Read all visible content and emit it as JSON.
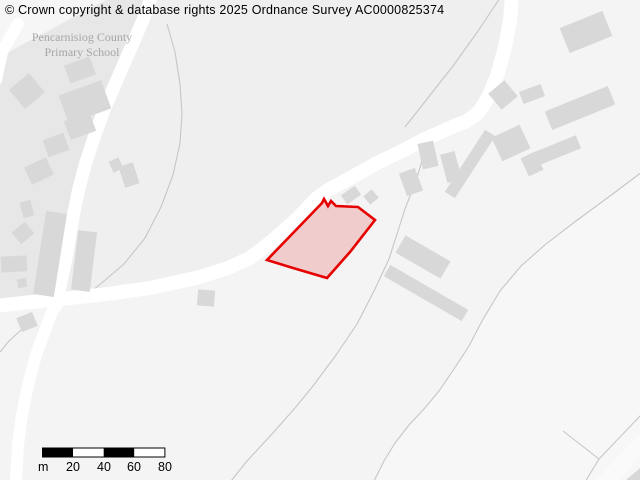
{
  "attribution": "© Crown copyright & database rights 2025 Ordnance Survey AC0000825374",
  "labels": {
    "school_line1": "Pencarnisiog County",
    "school_line2": "Primary School"
  },
  "scale_bar": {
    "unit": "m",
    "ticks": [
      "20",
      "40",
      "60",
      "80"
    ],
    "segment_meters": 20,
    "x": 42.5,
    "y": 448,
    "width": 122.4,
    "height": 9
  },
  "colors": {
    "background": "#efefef",
    "parcel_school": "#e7e7e7",
    "parcel_light": "#f4f4f4",
    "parcel_lighter": "#f7f7f7",
    "building": "#d8d8d8",
    "road": "#ffffff",
    "boundary": "#c6c6c6",
    "highlight_stroke": "#e60000",
    "highlight_fill": "rgba(230,0,0,0.16)",
    "text": "#000000",
    "label": "#a6a6a6"
  },
  "map": {
    "parcels": [
      {
        "name": "parcel-south-of-main-road",
        "points": "-6,312 50,307 100,302 150,295 196,285 228,275 250,265 272,248 297,226 317,205 328,197 352,184 377,170 402,158 427,145 452,134 467,128 479,119 489,103 498,80 505,54 510,28 512,-6 646,-6 646,486 -6,486",
        "fill": "#f4f4f4"
      },
      {
        "name": "parcel-east-of-long-boundary",
        "points": "642,172 610,196 576,221 546,244 521,266 500,291 482,321 469,346 454,369 439,391 424,409 409,425 395,443 384,461 374,481 646,481 646,172",
        "fill": "#f7f7f7"
      },
      {
        "name": "parcel-school-grounds",
        "points": "0,57 107,0 146,0 126,48 109,88 97,125 88,158 80,190 73,222 68,252 62,282 55,306 0,306",
        "fill": "#e7e7e7"
      },
      {
        "name": "parcel-northwest-corner",
        "points": "0,0 105,0 0,56",
        "fill": "#f6f6f6"
      },
      {
        "name": "track-bottom-right-corner",
        "path": "M 600 488 L 652 432",
        "width": 16,
        "stroke": "#fafafa"
      }
    ],
    "boundaries": [
      {
        "name": "boundary-school-field-curve",
        "path": "M 167 24 L 175 52 L 180 84 L 182 114 L 180 143 L 173 175 L 161 207 L 145 238 L 124 264 L 104 281 L 92 291"
      },
      {
        "name": "boundary-west-of-upper-road",
        "path": "M 500 -2 L 478 31 L 453 66 L 427 99 L 405 127"
      },
      {
        "name": "boundary-south-of-bend",
        "path": "M 420 142 L 424 154 L 417 178 L 405 209 L 397 234 L 389 259 L 374 291 L 357 324 L 336 355 L 313 386 L 295 408 L 272 434 L 247 461 L 231 481"
      },
      {
        "name": "boundary-long-east-curve",
        "path": "M 642 172 L 610 196 L 576 221 L 546 244 L 521 266 L 500 291 L 482 321 L 469 346 L 454 369 L 439 391 L 424 409 L 409 425 L 395 443 L 384 461 L 374 481"
      },
      {
        "name": "boundary-junction-southwest",
        "path": "M 33 321 L 20 331 L 9 341 L 0 352"
      },
      {
        "name": "boundary-corner-spur-left",
        "path": "M 563 431 L 599 459"
      },
      {
        "name": "boundary-corner-spur-right",
        "path": "M 641 415 L 599 459 L 585 482"
      }
    ],
    "roads": [
      {
        "name": "road-main",
        "path": "M -6 306 L 50 300 L 100 295 L 150 288 L 196 278 L 228 268 L 250 258 L 272 241 L 297 219 L 317 198 L 328 190 L 352 177 L 377 163 L 402 151 L 427 138 L 452 127 L 467 121 L 479 112 L 489 96 L 498 73 L 505 47 L 510 21 L 512 -6",
        "width": 14
      },
      {
        "name": "road-school",
        "path": "M 152 -6 L 143 20 L 130 50 L 116 82 L 104 110 L 95 135 L 86 162 L 79 188 L 74 212 L 70 235 L 66 258 L 61 282 L 56 306",
        "width": 13
      },
      {
        "name": "road-south-branch",
        "path": "M 56 302 L 47 325 L 36 355 L 28 385 L 22 415 L 18 445 L 16 482",
        "width": 12
      },
      {
        "name": "road-northwest-stub",
        "path": "M 18 24 L 2 52 L -4 80",
        "width": 12
      }
    ],
    "buildings": [
      {
        "cx": 27,
        "cy": 91,
        "w": 26,
        "h": 25,
        "rot": -40
      },
      {
        "cx": 80,
        "cy": 70,
        "w": 27,
        "h": 19,
        "rot": -20
      },
      {
        "cx": 85,
        "cy": 102,
        "w": 45,
        "h": 30,
        "rot": -20
      },
      {
        "cx": 80,
        "cy": 126,
        "w": 27,
        "h": 20,
        "rot": -20
      },
      {
        "cx": 56,
        "cy": 145,
        "w": 22,
        "h": 18,
        "rot": -20
      },
      {
        "cx": 39,
        "cy": 171,
        "w": 24,
        "h": 19,
        "rot": -25
      },
      {
        "cx": 27,
        "cy": 209,
        "w": 11,
        "h": 16,
        "rot": -15
      },
      {
        "cx": 23,
        "cy": 233,
        "w": 17,
        "h": 15,
        "rot": -40
      },
      {
        "cx": 14,
        "cy": 264,
        "w": 26,
        "h": 16,
        "rot": -3
      },
      {
        "cx": 22,
        "cy": 283,
        "w": 9,
        "h": 9,
        "rot": -10
      },
      {
        "cx": 50,
        "cy": 254,
        "w": 21,
        "h": 84,
        "rot": 9
      },
      {
        "cx": 84,
        "cy": 261,
        "w": 19,
        "h": 60,
        "rot": 7
      },
      {
        "cx": 116,
        "cy": 165,
        "w": 11,
        "h": 12,
        "rot": -25
      },
      {
        "cx": 129,
        "cy": 175,
        "w": 15,
        "h": 22,
        "rot": -18
      },
      {
        "cx": 27,
        "cy": 322,
        "w": 17,
        "h": 15,
        "rot": -22
      },
      {
        "cx": 206,
        "cy": 298,
        "w": 17,
        "h": 16,
        "rot": 5
      },
      {
        "cx": 503,
        "cy": 95,
        "w": 21,
        "h": 21,
        "rot": -40
      },
      {
        "cx": 532,
        "cy": 94,
        "w": 23,
        "h": 13,
        "rot": -20
      },
      {
        "cx": 580,
        "cy": 108,
        "w": 68,
        "h": 20,
        "rot": -22
      },
      {
        "cx": 511,
        "cy": 143,
        "w": 31,
        "h": 26,
        "rot": -25
      },
      {
        "cx": 532,
        "cy": 164,
        "w": 16,
        "h": 20,
        "rot": -25
      },
      {
        "cx": 558,
        "cy": 150,
        "w": 44,
        "h": 14,
        "rot": -22
      },
      {
        "cx": 470,
        "cy": 164,
        "w": 74,
        "h": 12,
        "rot": -57
      },
      {
        "cx": 428,
        "cy": 155,
        "w": 16,
        "h": 26,
        "rot": -12
      },
      {
        "cx": 451,
        "cy": 167,
        "w": 15,
        "h": 29,
        "rot": -15
      },
      {
        "cx": 411,
        "cy": 182,
        "w": 17,
        "h": 24,
        "rot": -20
      },
      {
        "cx": 586,
        "cy": 32,
        "w": 46,
        "h": 27,
        "rot": -22
      },
      {
        "cx": 351,
        "cy": 195,
        "w": 17,
        "h": 11,
        "rot": -35
      },
      {
        "cx": 371,
        "cy": 197,
        "w": 11,
        "h": 11,
        "rot": -40
      },
      {
        "cx": 423,
        "cy": 257,
        "w": 52,
        "h": 20,
        "rot": 30
      },
      {
        "cx": 426,
        "cy": 293,
        "w": 90,
        "h": 13,
        "rot": 30
      },
      {
        "cx": 638,
        "cy": 477,
        "w": 32,
        "h": 11,
        "rot": -40
      }
    ],
    "highlight": {
      "name": "highlighted-property-boundary",
      "points": "267,260 322,203 324,199 328,206 331,201 336,206 358,207 375,220 350,252 327,278 293,268",
      "stroke_width": 2.6
    }
  }
}
